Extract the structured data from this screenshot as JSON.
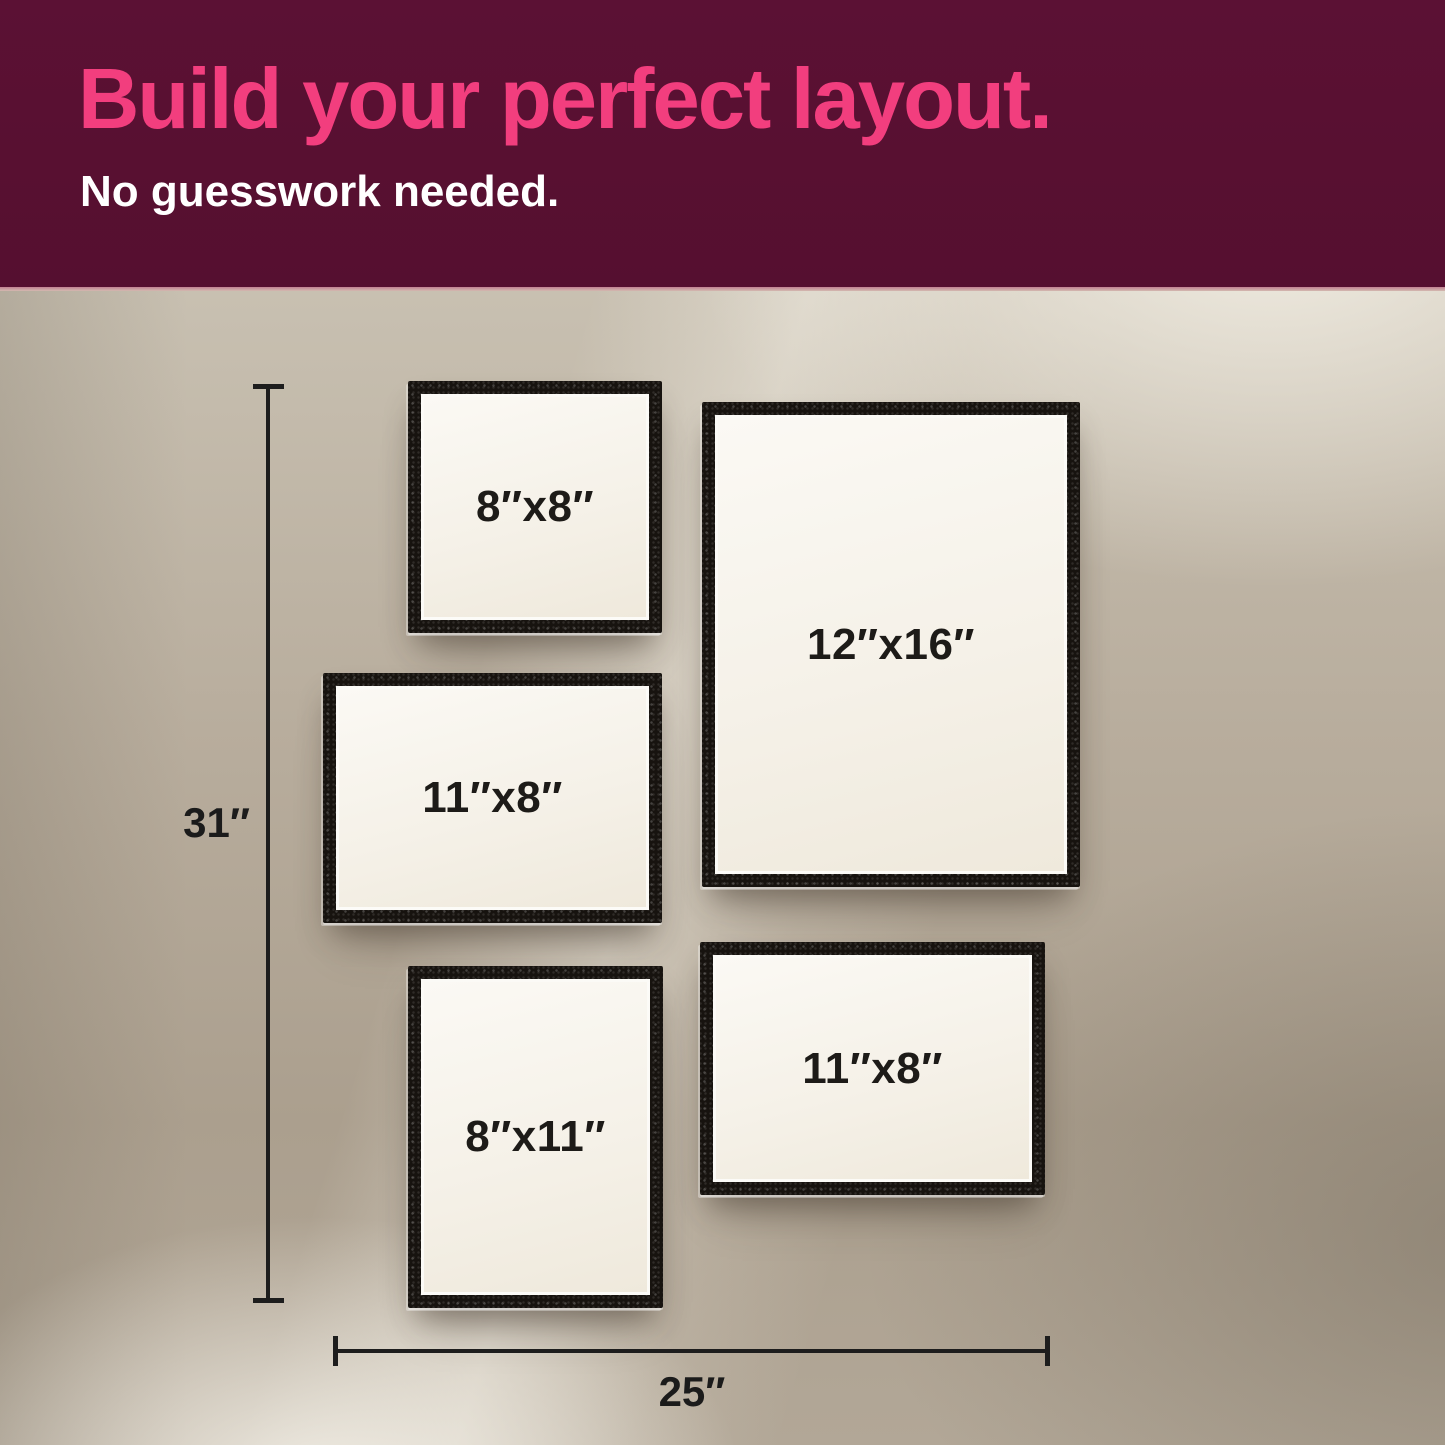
{
  "header": {
    "title": "Build your perfect layout.",
    "subtitle": "No guesswork needed.",
    "background_color": "#581031",
    "title_color": "#f23e7e",
    "subtitle_color": "#ffffff"
  },
  "scene": {
    "wall_color": "#b7ac9c",
    "frame_color": "#17130f",
    "paper_color": "#f5f1e8",
    "label_color": "#1d1b18",
    "frames": [
      {
        "name": "square-frame-top-left",
        "label": "8″x8″"
      },
      {
        "name": "large-portrait-frame-right",
        "label": "12″x16″"
      },
      {
        "name": "landscape-frame-middle-left",
        "label": "11″x8″"
      },
      {
        "name": "portrait-frame-bottom-left",
        "label": "8″x11″"
      },
      {
        "name": "landscape-frame-bottom-right",
        "label": "11″x8″"
      }
    ],
    "dimensions": {
      "vertical": {
        "label": "31″"
      },
      "horizontal": {
        "label": "25″"
      }
    }
  }
}
